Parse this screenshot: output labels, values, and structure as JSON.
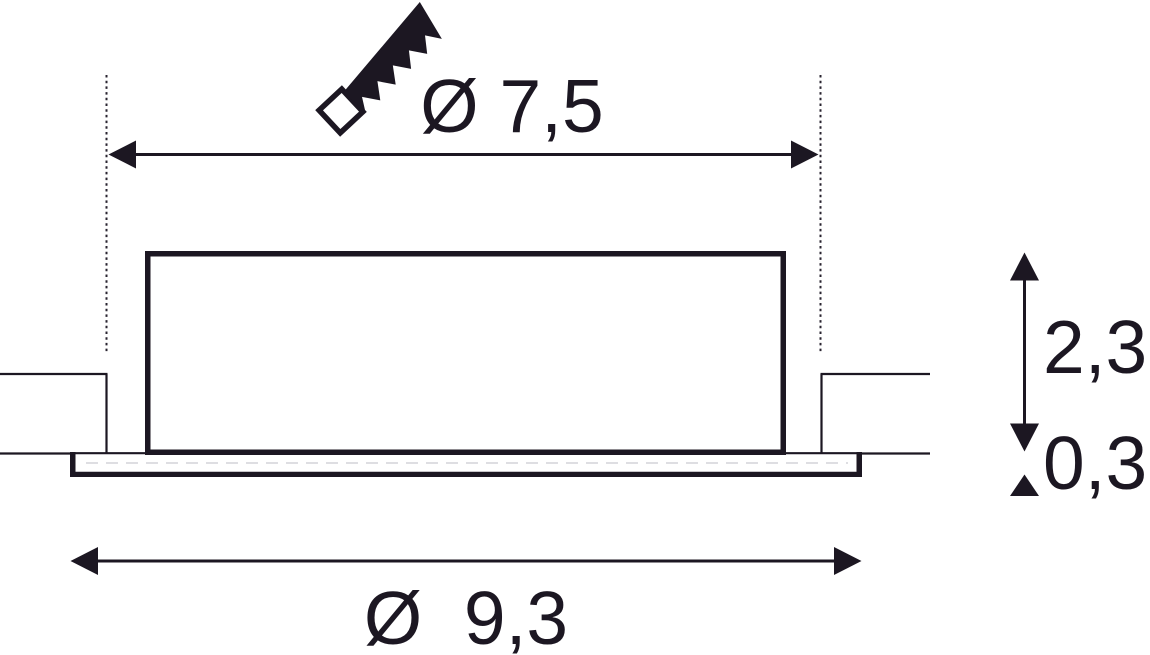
{
  "diagram": {
    "type": "technical-dimension-drawing",
    "subject": "recessed downlight, side section view with ceiling cutout",
    "labels": {
      "cutout_diameter": "Ø 7,5",
      "overall_diameter": "Ø  9,3",
      "housing_height": "2,3",
      "rim_thickness": "0,3"
    },
    "icons": {
      "saw": "hand-saw icon indicating ceiling cutout"
    },
    "colors": {
      "ink": "#1c1722",
      "background": "#ffffff",
      "faint_seam_line": "#d3d3d8"
    }
  }
}
